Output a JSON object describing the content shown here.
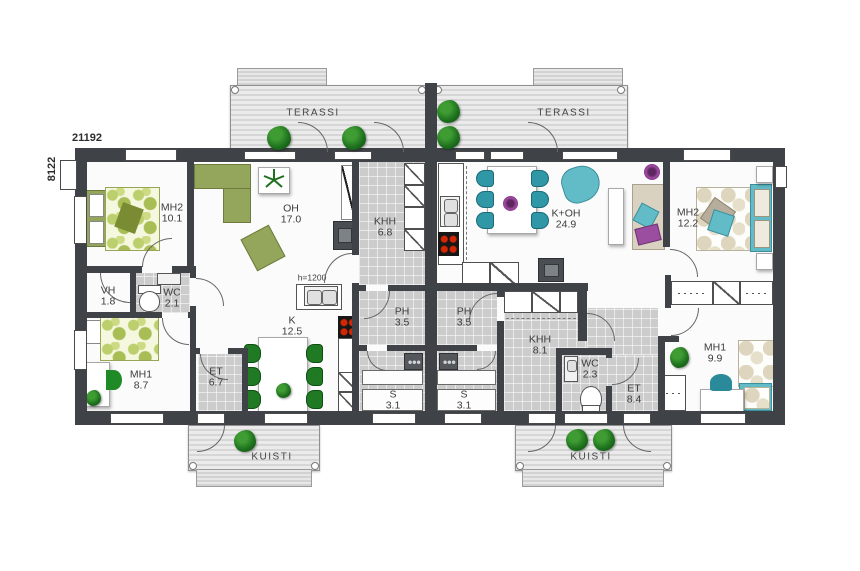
{
  "dimensions": {
    "width_label": "21192",
    "height_label": "8122"
  },
  "outdoor": {
    "terrace_left": "TERASSI",
    "terrace_right": "TERASSI",
    "porch_left": "KUISTI",
    "porch_right": "KUISTI"
  },
  "annotations": {
    "counter_height": "h=1200"
  },
  "left_apartment": {
    "rooms": [
      {
        "name": "MH2",
        "area": "10.1"
      },
      {
        "name": "OH",
        "area": "17.0"
      },
      {
        "name": "KHH",
        "area": "6.8"
      },
      {
        "name": "VH",
        "area": "1.8"
      },
      {
        "name": "WC",
        "area": "2.1"
      },
      {
        "name": "K",
        "area": "12.5"
      },
      {
        "name": "MH1",
        "area": "8.7"
      },
      {
        "name": "ET",
        "area": "6.7"
      },
      {
        "name": "PH",
        "area": "3.5"
      },
      {
        "name": "S",
        "area": "3.1"
      }
    ]
  },
  "right_apartment": {
    "rooms": [
      {
        "name": "K+OH",
        "area": "24.9"
      },
      {
        "name": "MH2",
        "area": "12.2"
      },
      {
        "name": "PH",
        "area": "3.5"
      },
      {
        "name": "S",
        "area": "3.1"
      },
      {
        "name": "KHH",
        "area": "8.1"
      },
      {
        "name": "WC",
        "area": "2.3"
      },
      {
        "name": "ET",
        "area": "8.4"
      },
      {
        "name": "MH1",
        "area": "9.9"
      }
    ]
  },
  "colors": {
    "wall": "#3f4347",
    "tile": "#cccccc",
    "olive": "#93a65b",
    "teal": "#62bcc8",
    "plant_green": "#1d701d",
    "burner_red": "#d32704",
    "purple": "#a24aa5"
  }
}
